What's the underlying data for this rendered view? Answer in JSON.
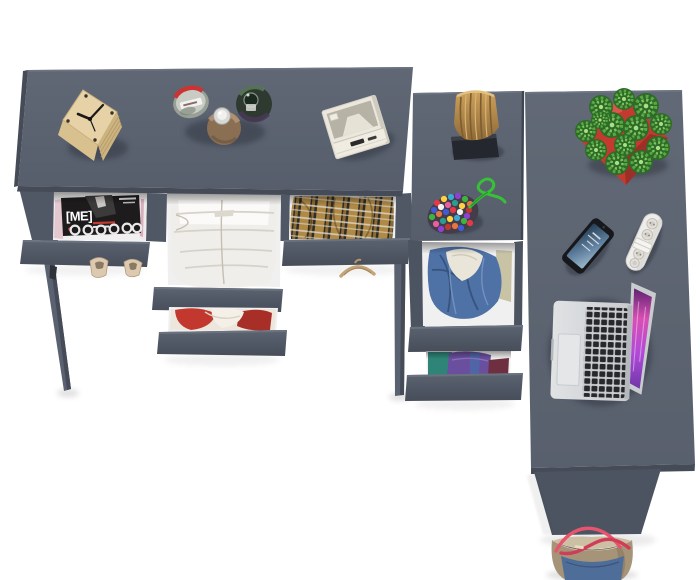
{
  "scene": {
    "type": "product-photo",
    "description": "Top-down render of a dark gray corner desk / dresser with open drawers full of clothes, accessories on top, on a white background"
  },
  "objects": {
    "magazine": {
      "title": "[ME]",
      "label": "Magazine stack in open drawer"
    },
    "clock": {
      "label": "Wooden cube clock"
    },
    "perfume_bottles": {
      "label": "Three perfume bottles"
    },
    "radio": {
      "label": "White retro radio"
    },
    "log_stool": {
      "label": "Wooden log on black stand"
    },
    "bead_pouch": {
      "label": "Beaded pouch with green cord"
    },
    "white_clothes": {
      "label": "Folded white trousers in drawer"
    },
    "plaid_shirt": {
      "label": "Plaid shirt in drawer"
    },
    "red_clothes": {
      "label": "Red and white clothes in drawer"
    },
    "denim_jacket": {
      "label": "Denim jacket in drawer"
    },
    "purple_clothes": {
      "label": "Folded purple and teal clothes in drawer"
    },
    "high_heels": {
      "label": "Beige high heel shoes"
    },
    "hanger": {
      "label": "Wooden hanger"
    },
    "plant": {
      "label": "Succulent in red pot"
    },
    "phone": {
      "label": "Smartphone"
    },
    "power_strip": {
      "label": "White power strip"
    },
    "laptop": {
      "label": "Open laptop with pink screen"
    },
    "tote_bag": {
      "label": "Denim tote bag with red handles"
    }
  },
  "colors": {
    "background": "#ffffff",
    "desk_gray": "#5b6270",
    "desk_gray_light": "#5e6574",
    "desk_edge_dark": "#454c58",
    "drawer_front": "#515865",
    "panel_side": "#4d5461",
    "leg_gray": "#5a6170",
    "interior_white": "#f0f0f1",
    "wood_clock": "#e6d2a6",
    "wood_stump": "#b18a4c",
    "stand_black": "#24272d",
    "plant_green": "#4f9e3a",
    "pot_red": "#c0392e",
    "denim_blue": "#4e71a6",
    "plaid_tan": "#b08a45",
    "magazine_black": "#1d1b1c",
    "clothes_white": "#f0eeea",
    "clothes_red": "#c2382f",
    "clothes_purple": "#6a4f9e",
    "clothes_teal": "#2e8577",
    "laptop_silver": "#d6d8da",
    "laptop_key": "#25272b",
    "screen_pink": "#d757b8",
    "phone_black": "#17181c",
    "strip_white": "#ededeb",
    "bag_taupe": "#a59478",
    "bag_denim": "#4e6d99",
    "bag_handle_red": "#e8546e",
    "shoe_beige": "#dcc9b0",
    "hanger_wood": "#c3a477",
    "cord_green": "#35c234"
  }
}
